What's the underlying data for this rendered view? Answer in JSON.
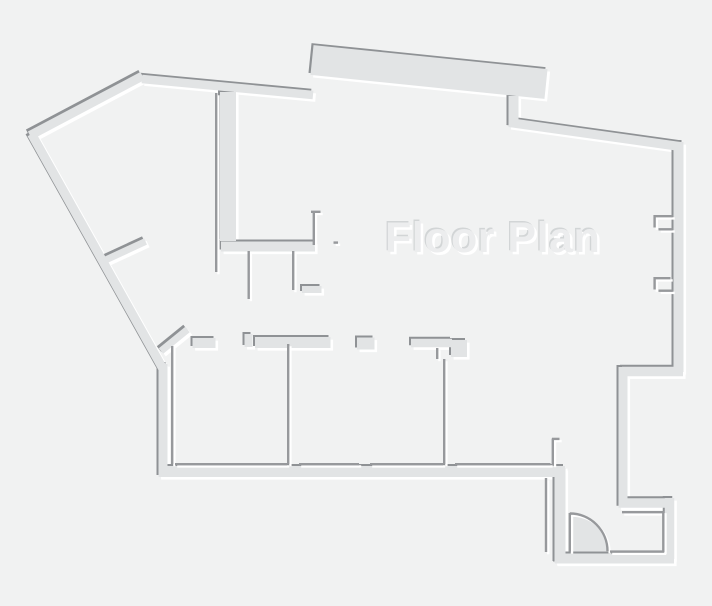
{
  "floor_plan": {
    "title": "Floor Plan",
    "colors": {
      "background": "#f1f2f2",
      "wall_fill": "#e2e4e5",
      "wall_shadow": "#8f9295",
      "interior_line": "#97999c",
      "highlight": "#ffffff",
      "title_fill": "#ecedee",
      "title_shadow_dark": "#d2d5d6"
    },
    "elements": {
      "outer_walls": "embossed thick outline of building",
      "top_slab": "thick protruding wall slab at top center",
      "c_room": "thick interior wall room at upper center",
      "bottom_rooms": "row of partitioned rooms along bottom with door jambs",
      "window_notches": "two bracket notches on right wall",
      "door": "quarter-circle door swing at bottom right",
      "stub_walls": "two diagonal stub walls on left side"
    }
  }
}
